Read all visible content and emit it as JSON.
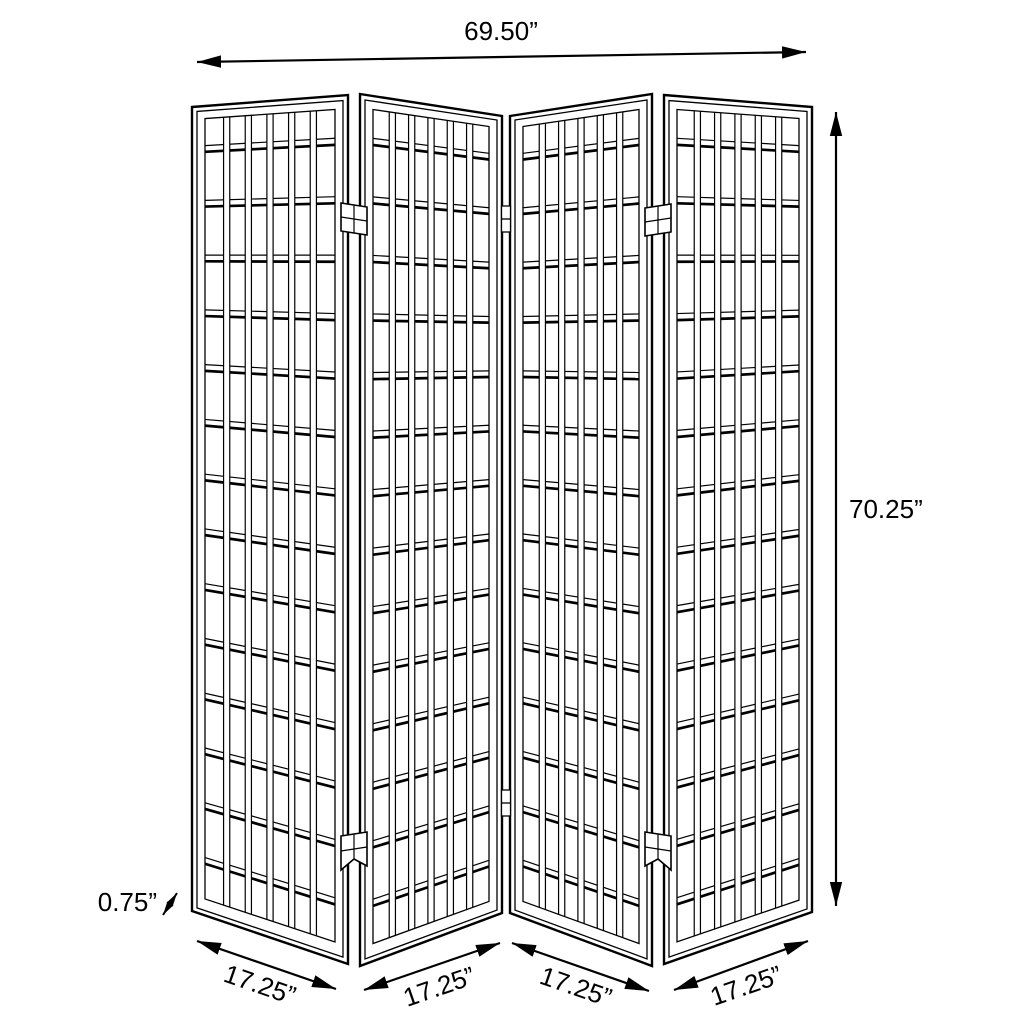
{
  "diagram": {
    "background_color": "#ffffff",
    "line_color": "#000000",
    "dimensions": {
      "overall_width": "69.50”",
      "overall_height": "70.25”",
      "panel_thickness": "0.75”",
      "panel_widths": [
        "17.25”",
        "17.25”",
        "17.25”",
        "17.25”"
      ]
    },
    "structure": {
      "panel_count": 4,
      "lattice_columns": 6,
      "lattice_rows": 15,
      "hinge_count": 6
    }
  }
}
